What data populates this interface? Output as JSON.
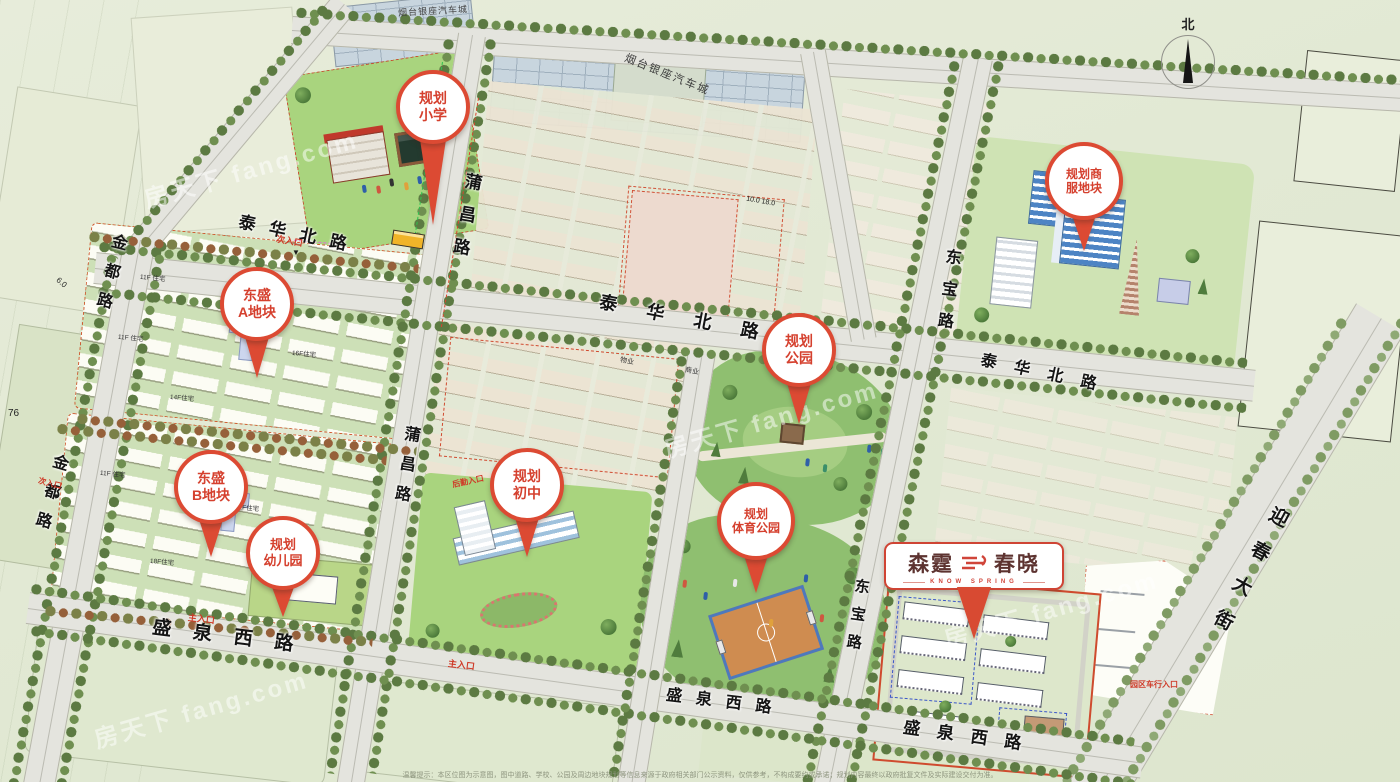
{
  "compass": {
    "label": "北"
  },
  "logo": {
    "name_left": "森霆",
    "name_right": "春晓",
    "subtitle": "KNOW SPRING"
  },
  "markers": [
    {
      "id": "planned-primary-school",
      "line1": "规划",
      "line2": "小学"
    },
    {
      "id": "planned-commercial-plot",
      "line1": "规划商",
      "line2": "服地块"
    },
    {
      "id": "planned-park",
      "line1": "规划",
      "line2": "公园"
    },
    {
      "id": "planned-junior-high",
      "line1": "规划",
      "line2": "初中"
    },
    {
      "id": "planned-sports-park",
      "line1": "规划",
      "line2": "体育公园"
    },
    {
      "id": "dongsheng-plot-a",
      "line1": "东盛",
      "line2": "A地块"
    },
    {
      "id": "dongsheng-plot-b",
      "line1": "东盛",
      "line2": "B地块"
    },
    {
      "id": "planned-kindergarten",
      "line1": "规划",
      "line2": "幼儿园"
    }
  ],
  "roads": {
    "taihua_north": "泰华北路",
    "puchang": "蒲昌路",
    "jindu": "金都路",
    "dongbao": "东宝路",
    "yingchun": "迎春大街",
    "shengquan_west": "盛泉西路"
  },
  "places": {
    "auto_city": "烟台银座汽车城",
    "wuye": "物业",
    "shangye": "商业"
  },
  "entrances": {
    "main": "主入口",
    "secondary": "次入口",
    "logistics": "后勤入口",
    "vehicle": "园区车行入口",
    "arrow_down": "▼",
    "arrow_left": "◀"
  },
  "figures": {
    "n76": "76",
    "n60": "6.0",
    "n10_18": "10.0 18.0"
  },
  "residential_labels": [
    "11F 住宅",
    "18F住宅",
    "11F 住宅",
    "16F住宅",
    "14F住宅",
    "11F 住宅",
    "12F住宅",
    "18F住宅"
  ],
  "watermark": "房天下 fang.com",
  "fineprint": "温馨提示：本区位图为示意图，图中道路、学校、公园及周边地块规划等信息来源于政府相关部门公示资料，仅供参考，不构成要约或承诺；规划内容最终以政府批复文件及实际建设交付为准。"
}
